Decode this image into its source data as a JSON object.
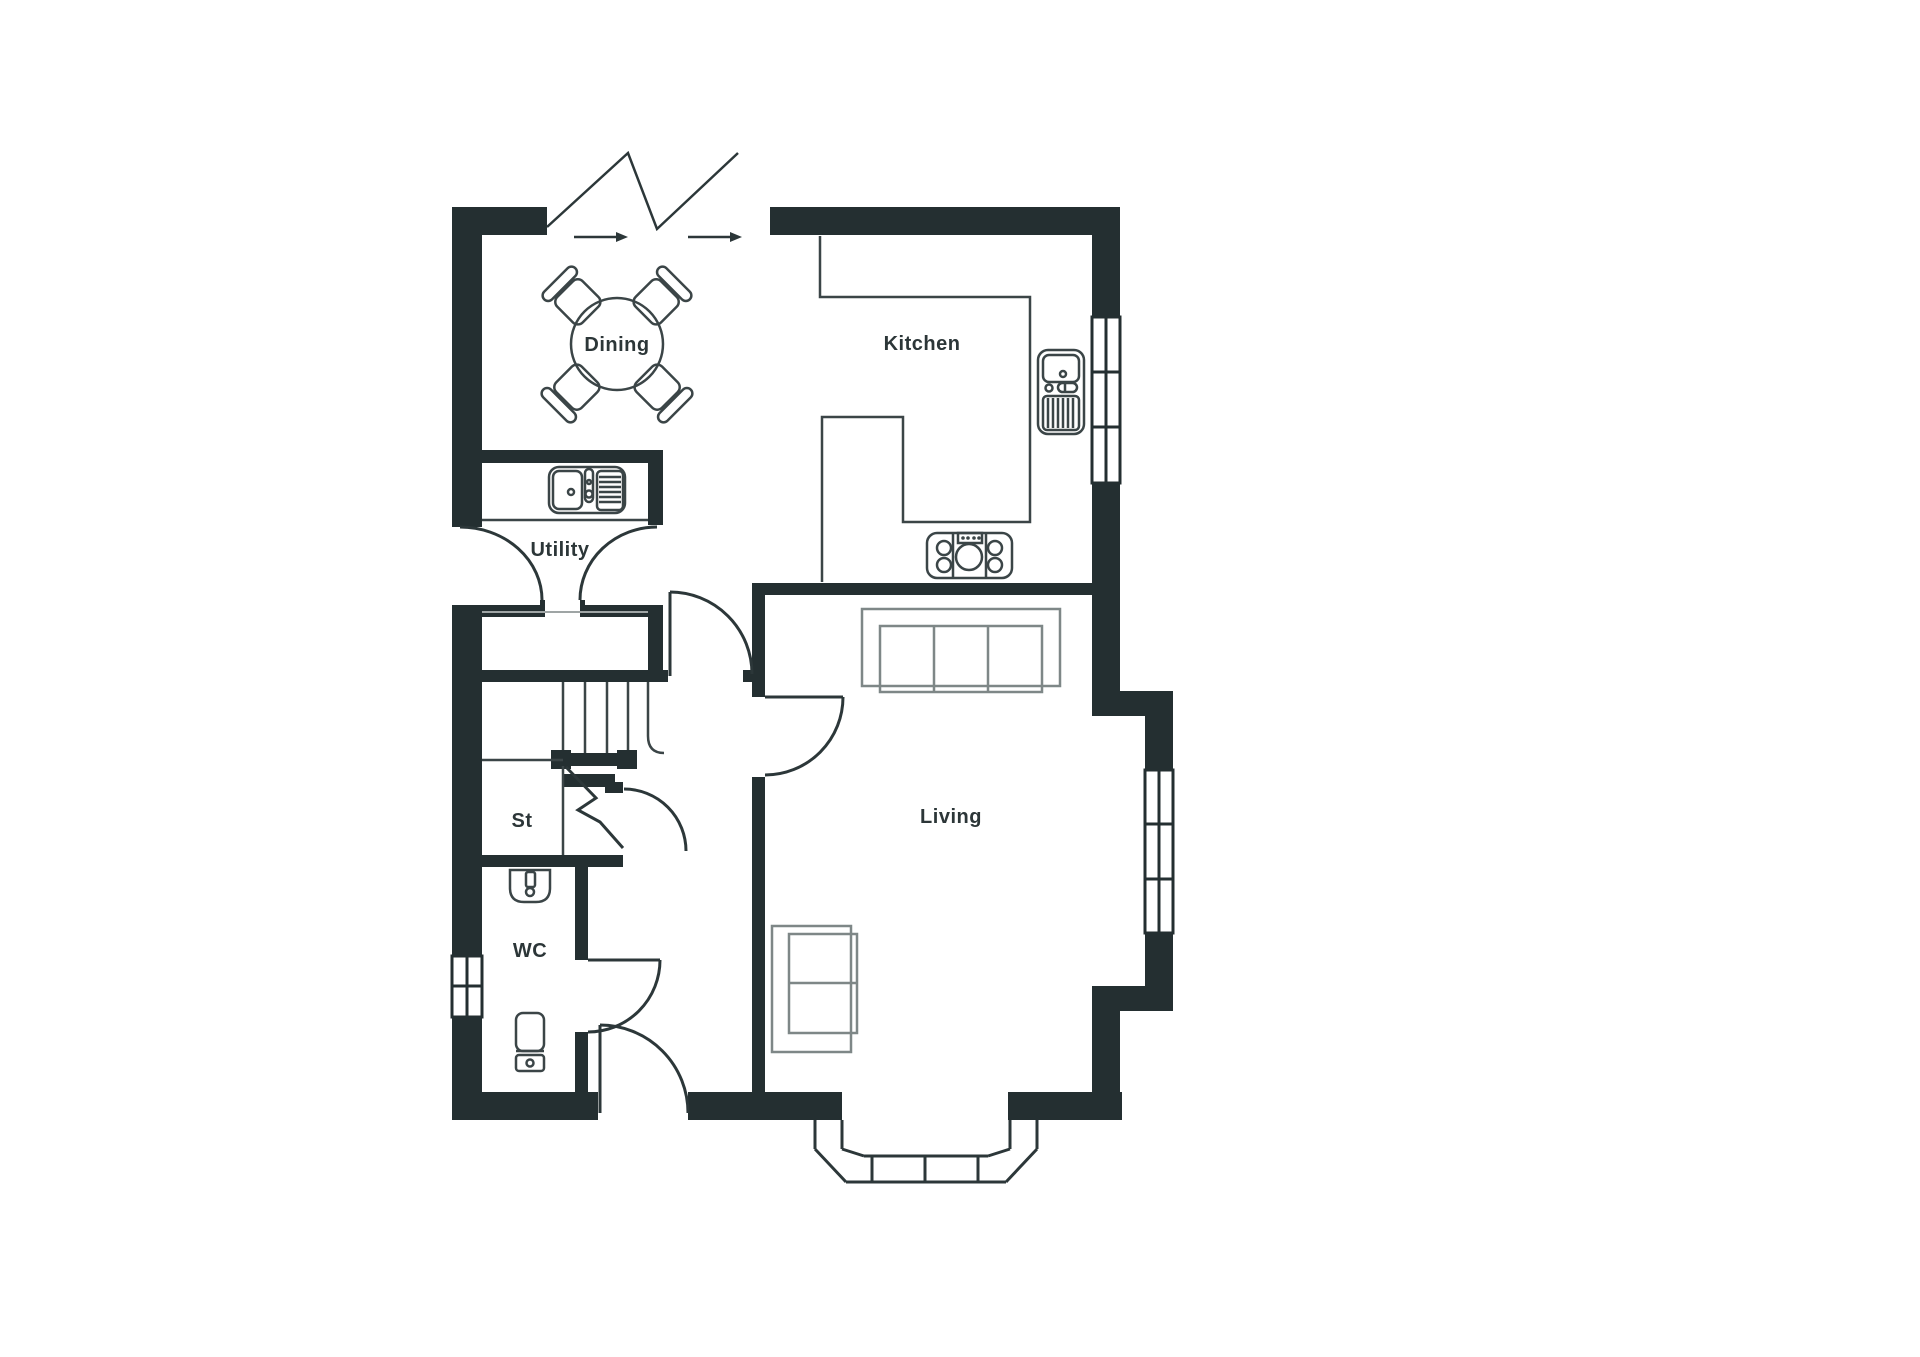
{
  "document": {
    "type": "floor-plan",
    "background": "#ffffff"
  },
  "colors": {
    "wall": "#242f31",
    "line": "#3b4547",
    "door": "#2c3739",
    "furniture": "#7e8787",
    "hairline": "#9fa5a5",
    "text": "#2c3638",
    "background": "#ffffff"
  },
  "rooms": {
    "dining": {
      "label": "Dining"
    },
    "kitchen": {
      "label": "Kitchen"
    },
    "utility": {
      "label": "Utility"
    },
    "store": {
      "label": "St"
    },
    "wc": {
      "label": "WC"
    },
    "living": {
      "label": "Living"
    }
  },
  "fixtures": [
    "entry-zigzag-icon",
    "entry-arrow-icon",
    "dining-table-icon",
    "dining-chair-icon",
    "kitchen-counter-icon",
    "kitchen-sink-icon",
    "hob-icon",
    "utility-sink-icon",
    "stairs-icon",
    "stair-break-icon",
    "wc-basin-icon",
    "wc-toilet-icon",
    "sofa-icon",
    "window-icon",
    "bay-window-icon",
    "door-swing-icon"
  ]
}
